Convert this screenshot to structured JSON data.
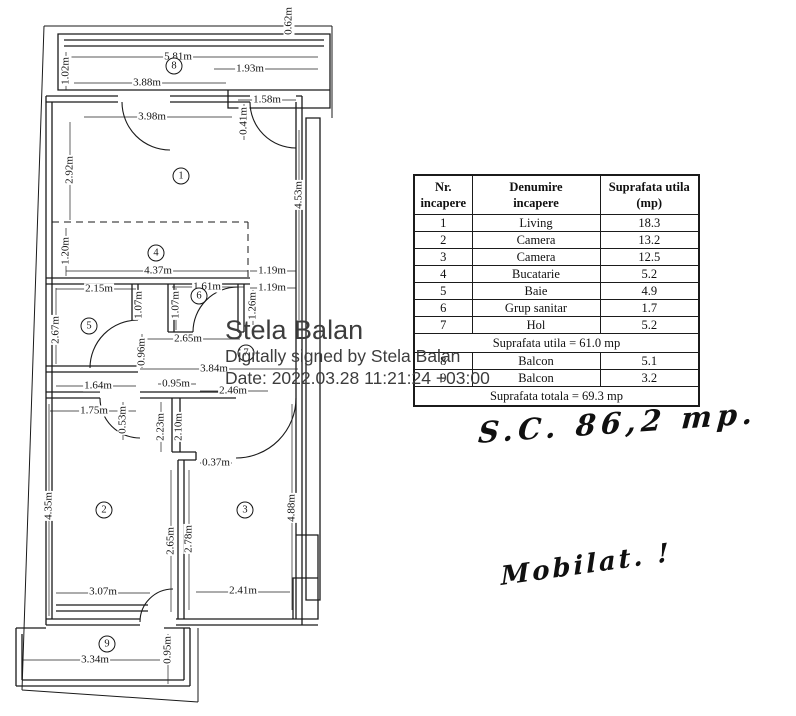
{
  "document": {
    "background": "#ffffff",
    "ink": "#161616",
    "signature_color": "#3d3d3d"
  },
  "table": {
    "headers": [
      "Nr.\nincapere",
      "Denumire\nincapere",
      "Suprafata utila\n(mp)"
    ],
    "rows": [
      [
        "1",
        "Living",
        "18.3"
      ],
      [
        "2",
        "Camera",
        "13.2"
      ],
      [
        "3",
        "Camera",
        "12.5"
      ],
      [
        "4",
        "Bucatarie",
        "5.2"
      ],
      [
        "5",
        "Baie",
        "4.9"
      ],
      [
        "6",
        "Grup sanitar",
        "1.7"
      ],
      [
        "7",
        "Hol",
        "5.2"
      ]
    ],
    "subtotal": "Suprafata utila = 61.0 mp",
    "balcony_rows": [
      [
        "8",
        "Balcon",
        "5.1"
      ],
      [
        "9",
        "Balcon",
        "3.2"
      ]
    ],
    "total": "Suprafata totala = 69.3 mp"
  },
  "signature": {
    "name": "Stela Balan",
    "details": "Digitally signed by Stela Balan",
    "date": "Date: 2022.03.28 11:21:24 +03:00"
  },
  "handwriting": {
    "area_note": "S.C.  86,2 mp.",
    "furnished_note": "Mobilat. !"
  },
  "floor_plan": {
    "rooms": [
      {
        "n": "8",
        "x": 174,
        "y": 66
      },
      {
        "n": "1",
        "x": 181,
        "y": 176
      },
      {
        "n": "4",
        "x": 156,
        "y": 253
      },
      {
        "n": "6",
        "x": 199,
        "y": 296
      },
      {
        "n": "5",
        "x": 89,
        "y": 326
      },
      {
        "n": "7",
        "x": 246,
        "y": 353
      },
      {
        "n": "2",
        "x": 104,
        "y": 510
      },
      {
        "n": "3",
        "x": 245,
        "y": 510
      },
      {
        "n": "9",
        "x": 107,
        "y": 644
      }
    ],
    "dimensions": [
      {
        "t": "0.62m",
        "x": 289,
        "y": 21,
        "v": true
      },
      {
        "t": "5.81m",
        "x": 178,
        "y": 57
      },
      {
        "t": "1.02m",
        "x": 66,
        "y": 71,
        "v": true
      },
      {
        "t": "1.93m",
        "x": 250,
        "y": 69
      },
      {
        "t": "3.88m",
        "x": 147,
        "y": 83
      },
      {
        "t": "1.58m",
        "x": 267,
        "y": 100
      },
      {
        "t": "3.98m",
        "x": 152,
        "y": 117
      },
      {
        "t": "0.41m",
        "x": 244,
        "y": 121,
        "v": true
      },
      {
        "t": "2.92m",
        "x": 70,
        "y": 170,
        "v": true
      },
      {
        "t": "4.53m",
        "x": 299,
        "y": 195,
        "v": true
      },
      {
        "t": "1.20m",
        "x": 66,
        "y": 251,
        "v": true
      },
      {
        "t": "4.37m",
        "x": 158,
        "y": 271
      },
      {
        "t": "1.19m",
        "x": 272,
        "y": 271
      },
      {
        "t": "2.15m",
        "x": 99,
        "y": 289
      },
      {
        "t": "1.61m",
        "x": 207,
        "y": 287
      },
      {
        "t": "1.19m",
        "x": 272,
        "y": 288
      },
      {
        "t": "1.07m",
        "x": 139,
        "y": 305,
        "v": true
      },
      {
        "t": "1.07m",
        "x": 176,
        "y": 305,
        "v": true
      },
      {
        "t": "1.26m",
        "x": 253,
        "y": 306,
        "v": true
      },
      {
        "t": "2.67m",
        "x": 56,
        "y": 330,
        "v": true
      },
      {
        "t": "2.65m",
        "x": 188,
        "y": 339
      },
      {
        "t": "0.96m",
        "x": 142,
        "y": 352,
        "v": true
      },
      {
        "t": "3.84m",
        "x": 214,
        "y": 369
      },
      {
        "t": "1.64m",
        "x": 98,
        "y": 386
      },
      {
        "t": "0.95m",
        "x": 176,
        "y": 384
      },
      {
        "t": "2.46m",
        "x": 233,
        "y": 391
      },
      {
        "t": "1.75m",
        "x": 94,
        "y": 411
      },
      {
        "t": "0.53m",
        "x": 123,
        "y": 420,
        "v": true
      },
      {
        "t": "2.23m",
        "x": 161,
        "y": 427,
        "v": true
      },
      {
        "t": "2.10m",
        "x": 179,
        "y": 427,
        "v": true
      },
      {
        "t": "0.37m",
        "x": 216,
        "y": 463
      },
      {
        "t": "4.35m",
        "x": 49,
        "y": 506,
        "v": true
      },
      {
        "t": "4.88m",
        "x": 292,
        "y": 508,
        "v": true
      },
      {
        "t": "2.65m",
        "x": 171,
        "y": 541,
        "v": true
      },
      {
        "t": "2.78m",
        "x": 189,
        "y": 539,
        "v": true
      },
      {
        "t": "3.07m",
        "x": 103,
        "y": 592
      },
      {
        "t": "2.41m",
        "x": 243,
        "y": 591
      },
      {
        "t": "3.34m",
        "x": 95,
        "y": 660
      },
      {
        "t": "0.95m",
        "x": 168,
        "y": 650,
        "v": true
      }
    ]
  }
}
